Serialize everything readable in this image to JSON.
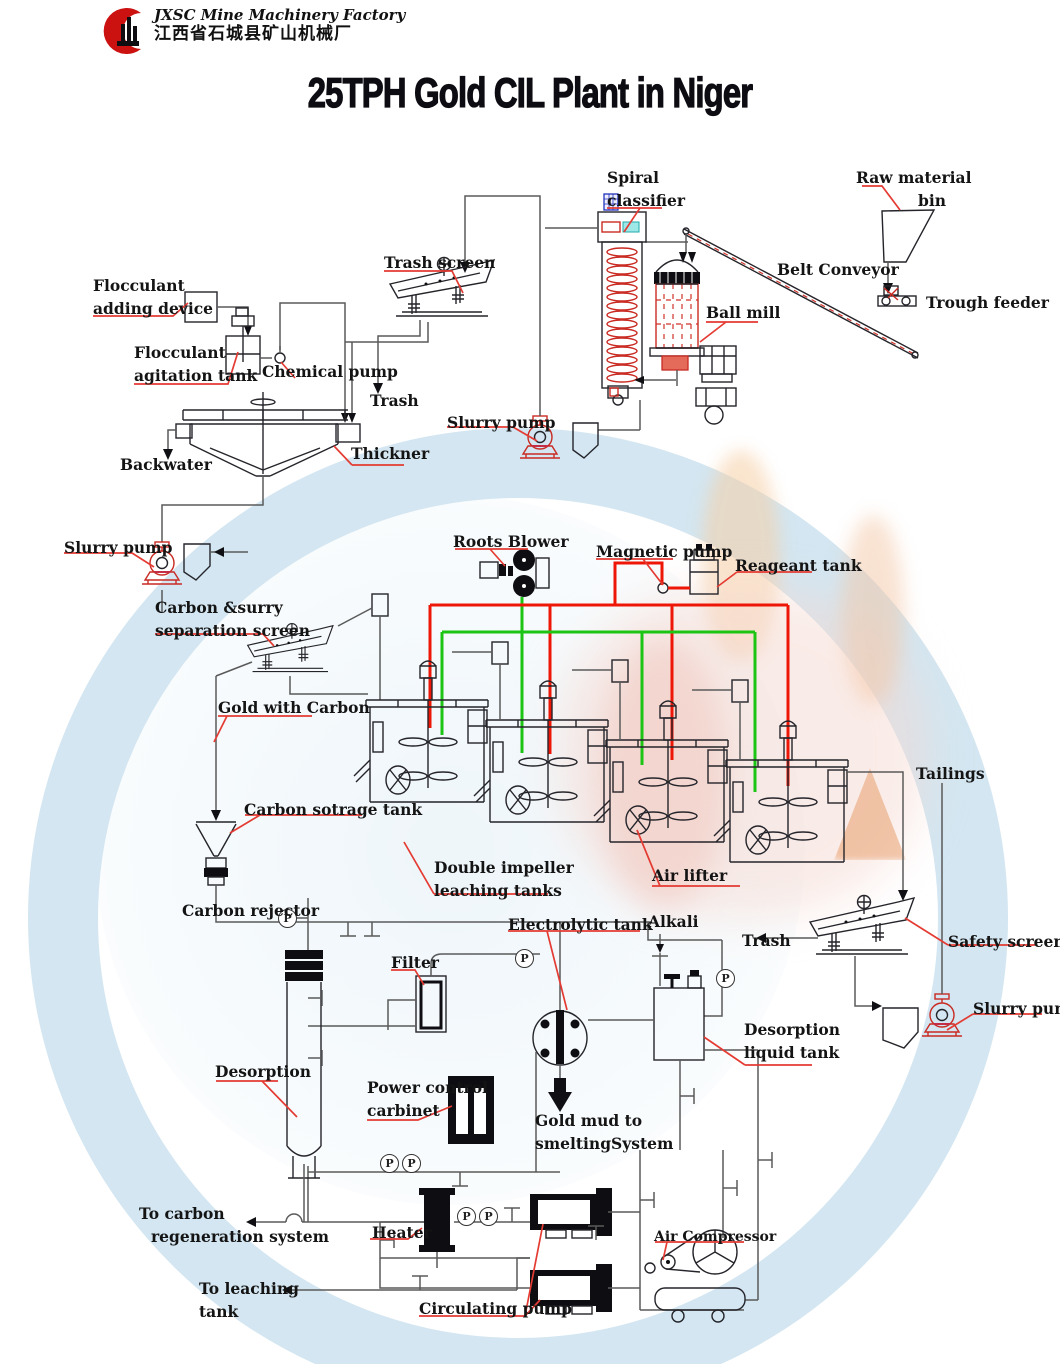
{
  "header": {
    "company_en": "JXSC Mine Machinery Factory",
    "company_cn": "江西省石城县矿山机械厂"
  },
  "title": "25TPH Gold CIL Plant in Niger",
  "icons": {
    "gauge_letter": "P"
  },
  "accent_colors": {
    "pipe_red": "#ee1607",
    "pipe_green": "#1cc414",
    "leader_red": "#e43b33",
    "logo_red": "#cc1111"
  },
  "labels": [
    {
      "id": "spiral-classifier",
      "lines": [
        "Spiral",
        "classifier"
      ],
      "x": 607,
      "y": 166
    },
    {
      "id": "raw-material-bin",
      "lines": [
        "Raw material",
        "bin"
      ],
      "x": 856,
      "y": 166,
      "dx": [
        0,
        62
      ]
    },
    {
      "id": "belt-conveyor",
      "lines": [
        "Belt Conveyor"
      ],
      "x": 777,
      "y": 258
    },
    {
      "id": "trough-feeder",
      "lines": [
        "Trough feeder"
      ],
      "x": 926,
      "y": 291
    },
    {
      "id": "ball-mill",
      "lines": [
        "Ball mill"
      ],
      "x": 706,
      "y": 301
    },
    {
      "id": "trash-screen",
      "lines": [
        "Trash screen"
      ],
      "x": 384,
      "y": 251
    },
    {
      "id": "flocculant-adding-device",
      "lines": [
        "Flocculant",
        "adding device"
      ],
      "x": 93,
      "y": 274
    },
    {
      "id": "flocculant-agitation-tank",
      "lines": [
        "Flocculant",
        "agitation tank"
      ],
      "x": 134,
      "y": 341
    },
    {
      "id": "chemical-pump",
      "lines": [
        "Chemical pump"
      ],
      "x": 262,
      "y": 360
    },
    {
      "id": "trash-top",
      "lines": [
        "Trash"
      ],
      "x": 370,
      "y": 389
    },
    {
      "id": "slurry-pump-mill",
      "lines": [
        "Slurry pump"
      ],
      "x": 447,
      "y": 411
    },
    {
      "id": "thickner",
      "lines": [
        "Thickner"
      ],
      "x": 351,
      "y": 442
    },
    {
      "id": "backwater",
      "lines": [
        "Backwater"
      ],
      "x": 120,
      "y": 453
    },
    {
      "id": "slurry-pump-thickener",
      "lines": [
        "Slurry pump"
      ],
      "x": 64,
      "y": 536
    },
    {
      "id": "roots-blower",
      "lines": [
        "Roots Blower"
      ],
      "x": 453,
      "y": 530
    },
    {
      "id": "magnetic-pump",
      "lines": [
        "Magnetic pump"
      ],
      "x": 596,
      "y": 540
    },
    {
      "id": "reageant-tank",
      "lines": [
        "Reageant tank"
      ],
      "x": 735,
      "y": 554
    },
    {
      "id": "carbon-slurry-separation-screen",
      "lines": [
        "Carbon &surry",
        "separation screen"
      ],
      "x": 155,
      "y": 596
    },
    {
      "id": "gold-with-carbon",
      "lines": [
        "Gold with Carbon"
      ],
      "x": 218,
      "y": 696
    },
    {
      "id": "carbon-sotrage-tank",
      "lines": [
        "Carbon sotrage tank"
      ],
      "x": 244,
      "y": 798
    },
    {
      "id": "double-impeller-leaching-tanks",
      "lines": [
        "Double impeller",
        "leaching tanks"
      ],
      "x": 434,
      "y": 856
    },
    {
      "id": "air-lifter",
      "lines": [
        "Air lifter"
      ],
      "x": 652,
      "y": 864
    },
    {
      "id": "tailings",
      "lines": [
        "Tailings"
      ],
      "x": 916,
      "y": 762
    },
    {
      "id": "carbon-rejector",
      "lines": [
        "Carbon rejector"
      ],
      "x": 182,
      "y": 899
    },
    {
      "id": "electrolytic-tank",
      "lines": [
        "Electrolytic tank"
      ],
      "x": 508,
      "y": 913
    },
    {
      "id": "alkali",
      "lines": [
        "Alkali"
      ],
      "x": 648,
      "y": 910
    },
    {
      "id": "trash-safety",
      "lines": [
        "Trash"
      ],
      "x": 742,
      "y": 929
    },
    {
      "id": "safety-screen",
      "lines": [
        "Safety screen"
      ],
      "x": 948,
      "y": 930
    },
    {
      "id": "slurry-pump-tailings",
      "lines": [
        "Slurry pump"
      ],
      "x": 973,
      "y": 997
    },
    {
      "id": "filter",
      "lines": [
        "Filter"
      ],
      "x": 391,
      "y": 951
    },
    {
      "id": "desorption-liquid-tank",
      "lines": [
        "Desorption",
        "liquid tank"
      ],
      "x": 744,
      "y": 1018
    },
    {
      "id": "desorption",
      "lines": [
        "Desorption"
      ],
      "x": 215,
      "y": 1060
    },
    {
      "id": "power-control-carbinet",
      "lines": [
        "Power control",
        "carbinet"
      ],
      "x": 367,
      "y": 1076
    },
    {
      "id": "gold-mud-to-smelting",
      "lines": [
        "Gold mud to",
        "smeltingSystem"
      ],
      "x": 535,
      "y": 1109
    },
    {
      "id": "to-carbon-regeneration",
      "lines": [
        "To carbon",
        "regeneration system"
      ],
      "x": 139,
      "y": 1202,
      "dx": [
        0,
        12
      ]
    },
    {
      "id": "heater",
      "lines": [
        "Heater"
      ],
      "x": 372,
      "y": 1221
    },
    {
      "id": "to-leaching-tank",
      "lines": [
        "To leaching",
        "tank"
      ],
      "x": 199,
      "y": 1277
    },
    {
      "id": "circulating-pump",
      "lines": [
        "Circulating pump"
      ],
      "x": 419,
      "y": 1297
    },
    {
      "id": "air-compressor",
      "lines": [
        "Air Compressor"
      ],
      "x": 654,
      "y": 1226,
      "size": 14
    }
  ]
}
